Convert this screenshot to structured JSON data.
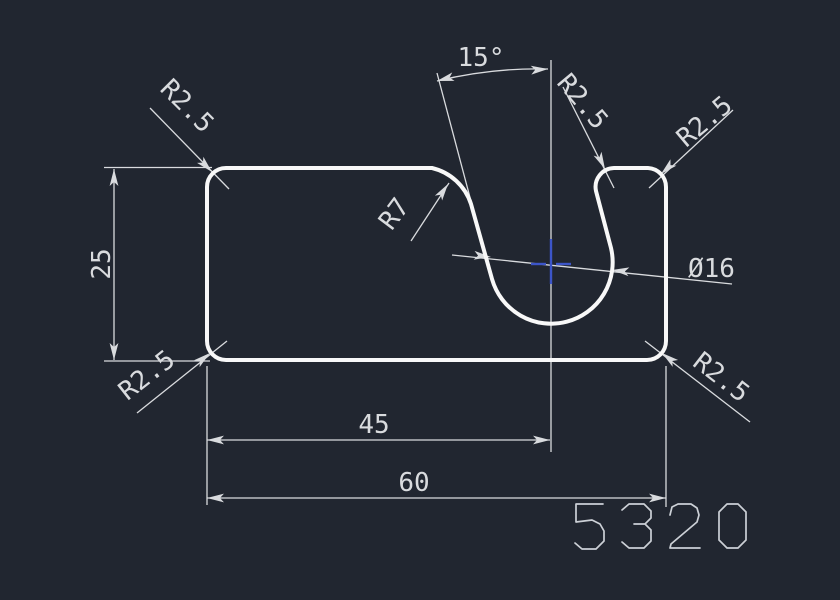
{
  "viewport": {
    "type": "cad-drawing-canvas"
  },
  "labels": {
    "dim_height": "25",
    "dim_width_total": "60",
    "dim_slot_center": "45",
    "slot_angle": "15°",
    "slot_diameter": "Ø16",
    "fillet_r7": "R7",
    "r25_top_left": "R2.5",
    "r25_slot_edge": "R2.5",
    "r25_tab_right": "R2.5",
    "r25_bottom_left": "R2.5",
    "r25_bottom_right": "R2.5",
    "part_number": "5320"
  },
  "colors": {
    "background": "#212630",
    "geometry": "#f8f8f8",
    "dimension": "#d9dbde",
    "part_number": "#ccd0d6",
    "snap_marker": "#3c55c8"
  }
}
